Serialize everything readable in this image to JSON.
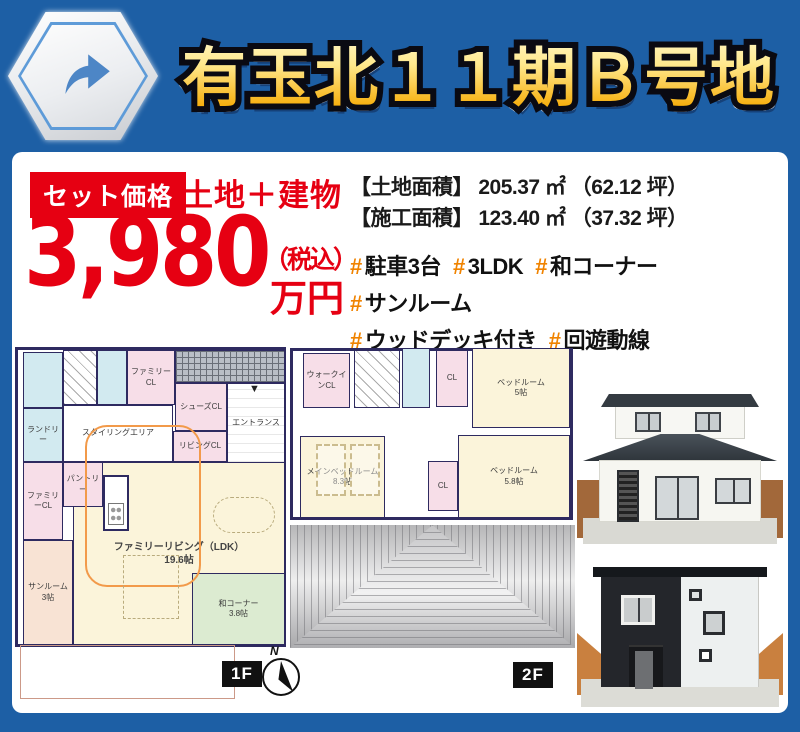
{
  "header": {
    "title": "有玉北１１期Ｂ号地"
  },
  "colors": {
    "frame_blue": "#1d5fa5",
    "price_red": "#e60012",
    "hashtag_orange": "#f08300",
    "title_gold_top": "#fff9d6",
    "title_gold_bottom": "#e78a00",
    "plan_wall_navy": "#2e2a60"
  },
  "price": {
    "badge": "セット価格",
    "set_label": "土地＋建物",
    "amount": "3,980",
    "tax_note": "（税込）",
    "unit": "万円"
  },
  "details": {
    "areas": [
      {
        "label": "【土地面積】",
        "value": "205.37 ㎡",
        "tsubo": "（62.12 坪）"
      },
      {
        "label": "【施工面積】",
        "value": "123.40 ㎡",
        "tsubo": "（37.32 坪）"
      }
    ],
    "hash_symbol": "#",
    "hashtag_lines": [
      [
        "駐車3台",
        "3LDK",
        "和コーナー",
        "サンルーム"
      ],
      [
        "ウッドデッキ付き",
        "回遊動線"
      ]
    ]
  },
  "floorplans": {
    "compass_label": "N",
    "f1": {
      "badge": "1F",
      "entrance_marker": "▼",
      "rooms": [
        {
          "label": "",
          "x": 8,
          "y": 5,
          "w": 40,
          "h": 56,
          "bg": "blue",
          "name": "bathroom"
        },
        {
          "label": "ランドリー",
          "x": 8,
          "y": 61,
          "w": 40,
          "h": 54,
          "bg": "blue",
          "name": "laundry"
        },
        {
          "label": "ファミリーCL",
          "x": 8,
          "y": 115,
          "w": 40,
          "h": 78,
          "bg": "pink",
          "name": "family-closet-west"
        },
        {
          "label": "",
          "x": 48,
          "y": 3,
          "w": 34,
          "h": 55,
          "bg": "diag",
          "name": "stairs"
        },
        {
          "label": "",
          "x": 82,
          "y": 3,
          "w": 30,
          "h": 55,
          "bg": "blue",
          "name": "toilet"
        },
        {
          "label": "ファミリーCL",
          "x": 112,
          "y": 3,
          "w": 48,
          "h": 55,
          "bg": "pink",
          "name": "family-closet-north"
        },
        {
          "label": "",
          "x": 160,
          "y": 3,
          "w": 110,
          "h": 33,
          "bg": "hatch",
          "name": "porch"
        },
        {
          "label": "シューズCL",
          "x": 160,
          "y": 36,
          "w": 52,
          "h": 48,
          "bg": "pink",
          "name": "shoes-closet"
        },
        {
          "label": "エントランス",
          "x": 212,
          "y": 36,
          "w": 58,
          "h": 80,
          "bg": "entry",
          "name": "entrance"
        },
        {
          "label": "リビングCL",
          "x": 158,
          "y": 84,
          "w": 54,
          "h": 31,
          "bg": "pink",
          "name": "living-closet"
        },
        {
          "label": "スタイリングエリア",
          "x": 48,
          "y": 58,
          "w": 110,
          "h": 57,
          "bg": "white",
          "name": "styling-area"
        },
        {
          "label": "ファミリーリビング（LDK）\n19.6帖",
          "x": 58,
          "y": 115,
          "w": 212,
          "h": 183,
          "bg": "cream",
          "name": "family-living-ldk"
        },
        {
          "label": "パントリー",
          "x": 48,
          "y": 115,
          "w": 40,
          "h": 45,
          "bg": "pink",
          "name": "pantry"
        },
        {
          "label": "サンルーム\n3帖",
          "x": 8,
          "y": 193,
          "w": 50,
          "h": 105,
          "bg": "peach",
          "name": "sunroom"
        },
        {
          "label": "和コーナー\n3.8帖",
          "x": 177,
          "y": 226,
          "w": 93,
          "h": 72,
          "bg": "green",
          "name": "washitsu-corner"
        },
        {
          "label": "",
          "x": 5,
          "y": 298,
          "w": 215,
          "h": 54,
          "bg": "deck",
          "name": "wood-deck"
        }
      ]
    },
    "f2": {
      "badge": "2F",
      "rooms": [
        {
          "label": "ウォークインCL",
          "x": 13,
          "y": 5,
          "w": 47,
          "h": 55,
          "bg": "pink",
          "name": "walkin-closet"
        },
        {
          "label": "",
          "x": 64,
          "y": 2,
          "w": 46,
          "h": 58,
          "bg": "diag",
          "name": "stairs-2f"
        },
        {
          "label": "",
          "x": 112,
          "y": 0,
          "w": 28,
          "h": 60,
          "bg": "blue",
          "name": "toilet-2f"
        },
        {
          "label": "CL",
          "x": 146,
          "y": 2,
          "w": 32,
          "h": 57,
          "bg": "pink",
          "name": "closet-north"
        },
        {
          "label": "ベッドルーム\n5帖",
          "x": 182,
          "y": 0,
          "w": 98,
          "h": 80,
          "bg": "cream",
          "name": "bedroom-5"
        },
        {
          "label": "メインベッドルーム\n8.3帖",
          "x": 10,
          "y": 88,
          "w": 85,
          "h": 82,
          "bg": "cream",
          "name": "main-bedroom"
        },
        {
          "label": "CL",
          "x": 138,
          "y": 113,
          "w": 30,
          "h": 50,
          "bg": "pink",
          "name": "closet-mid"
        },
        {
          "label": "ベッドルーム\n5.8帖",
          "x": 168,
          "y": 87,
          "w": 112,
          "h": 83,
          "bg": "cream",
          "name": "bedroom-58"
        }
      ]
    }
  }
}
